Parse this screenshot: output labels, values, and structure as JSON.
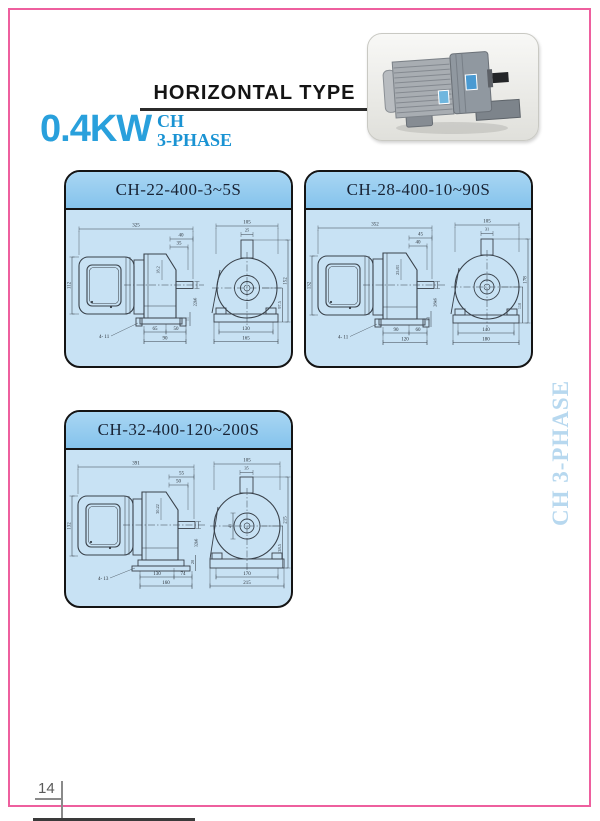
{
  "page": {
    "title": "HORIZONTAL TYPE",
    "power_rating": "0.4KW",
    "series_name": "CH",
    "series_phase": "3-PHASE",
    "side_tab_label": "CH 3-PHASE",
    "page_number": "14",
    "frame_color": "#ee5f9e",
    "accent_blue": "#29a0dc",
    "panel_header_color": "#8fc8ee",
    "panel_body_color": "#c8e2f4"
  },
  "photo": {
    "label": "gear-motor-photo"
  },
  "panels": [
    {
      "title": "CH-22-400-3~5S",
      "side": {
        "overall": "325",
        "top1": "40",
        "top2": "35",
        "key": "18.2",
        "height": "112",
        "shaft": "22k6",
        "holes": "4- 11",
        "bot1": "65",
        "bot2": "50",
        "bot3": "90",
        "vsmall": "11"
      },
      "front": {
        "top": "105",
        "boss": "25",
        "height": "152",
        "center": "97.5",
        "feet": "130",
        "base": "165"
      }
    },
    {
      "title": "CH-28-400-10~90S",
      "side": {
        "overall": "352",
        "top1": "45",
        "top2": "40",
        "key": "25.83",
        "height": "132",
        "shaft": "28k6",
        "holes": "4- 11",
        "bot1": "90",
        "bot2": "60",
        "bot3": "120",
        "vsmall": "13"
      },
      "front": {
        "top": "105",
        "boss": "31",
        "height": "178",
        "center": "110",
        "feet": "140",
        "base": "180"
      }
    },
    {
      "title": "CH-32-400-120~200S",
      "side": {
        "overall": "391",
        "top1": "55",
        "top2": "50",
        "key": "30.22",
        "height": "132",
        "shaft": "32k6",
        "holes": "4- 13",
        "bot1": "130",
        "bot2": "74",
        "bot3": "160",
        "vsmall": "20"
      },
      "front": {
        "top": "105",
        "boss": "35",
        "height": "215",
        "center": "138.5",
        "hub": "40",
        "feet": "170",
        "base": "215"
      }
    }
  ]
}
